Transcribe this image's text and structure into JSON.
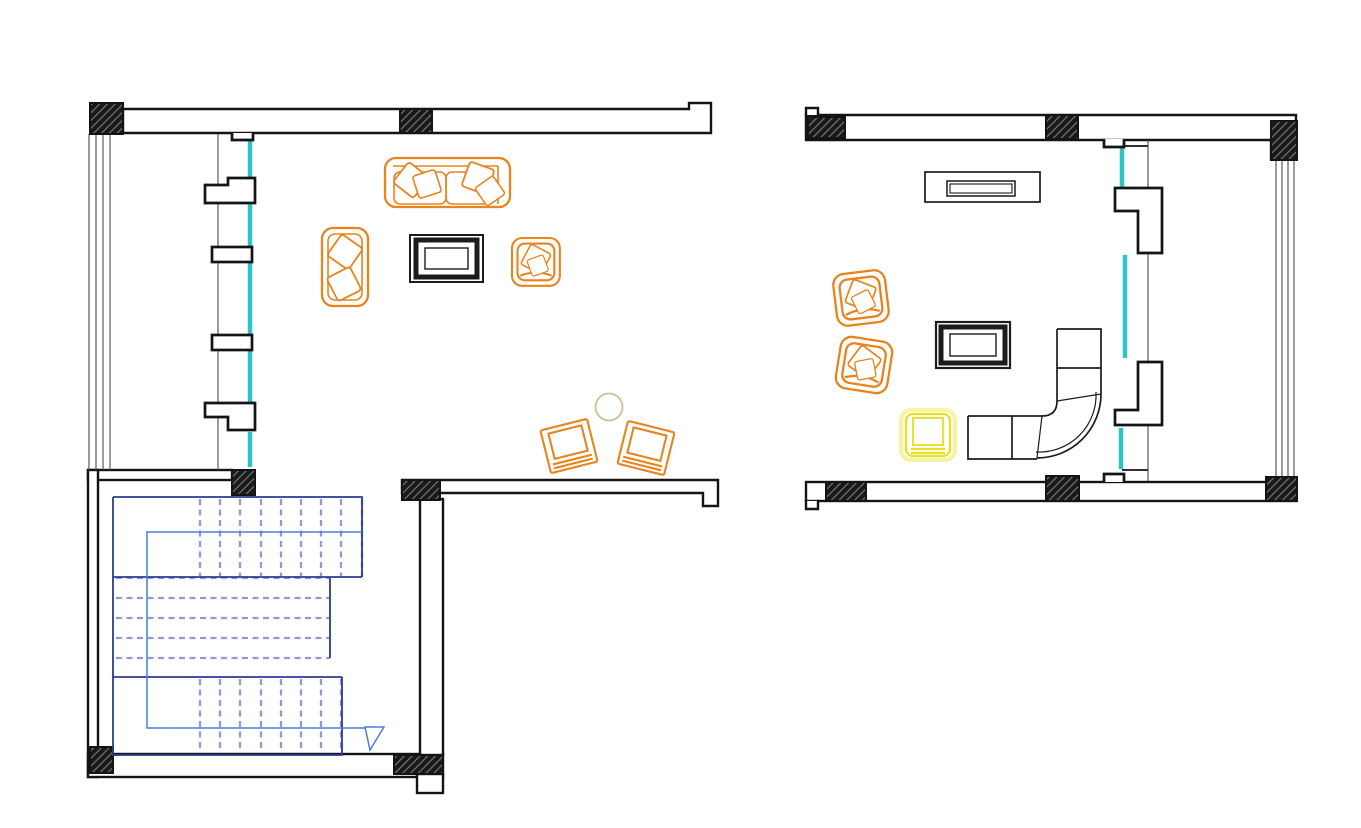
{
  "document": {
    "kind": "architectural-floor-plan-drawing",
    "background": "#ffffff"
  },
  "colors": {
    "wall": "#141414",
    "frame_gray": "#4a4a4a",
    "window_teal": "#2ec4c5",
    "furniture_orange": "#e8831e",
    "furniture_yellow": "#e9e021",
    "furniture_yellow_halo": "#f6f3a2",
    "table_khaki": "#cdbf8e",
    "sofa_black": "#1c1c1c",
    "stair_outline": "#2b3a96",
    "stair_steps": "#9199d6",
    "stair_walkline": "#4a7fd6"
  },
  "plans": [
    {
      "name": "lower-floor-plan",
      "rooms": [
        {
          "name": "living-room",
          "furniture": [
            "three-seat-sofa",
            "lounge-chair",
            "coffee-table",
            "armchair",
            "round-side-table",
            "guest-chair",
            "guest-chair"
          ]
        },
        {
          "name": "stair-hall",
          "furniture": [
            "u-shaped-staircase"
          ]
        }
      ]
    },
    {
      "name": "upper-floor-plan",
      "rooms": [
        {
          "name": "family-room",
          "furniture": [
            "media-console",
            "lounge-chair",
            "lounge-chair",
            "coffee-table",
            "yellow-armchair",
            "corner-sectional-sofa"
          ]
        }
      ]
    }
  ]
}
